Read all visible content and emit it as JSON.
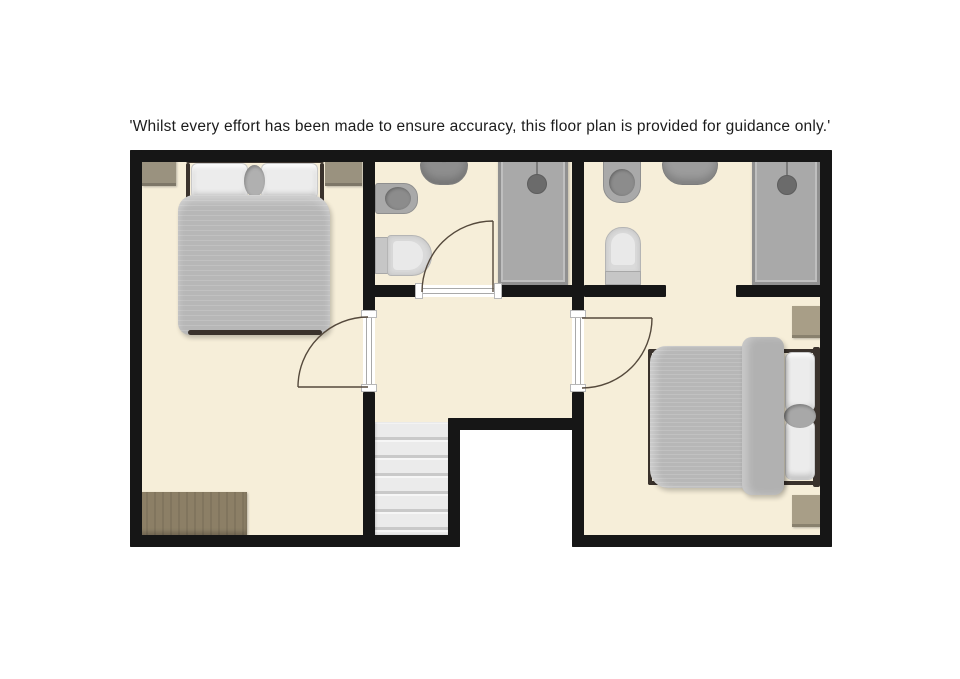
{
  "disclaimer": "'Whilst every effort has been made to ensure accuracy, this floor plan is provided for guidance only.'",
  "palette": {
    "canvas": "#ffffff",
    "wall": "#161616",
    "floor": "#f6eed9",
    "text": "#1c1c1c",
    "bed-duvet": "#b7b7b7",
    "pillow": "#ececec",
    "bed-frame": "#3a322c",
    "nightstand-1": "#9a927f",
    "nightstand-2": "#a89e87",
    "dresser": "#8c7f66",
    "shower": "#a9a9a9",
    "door-line": "#55493c"
  },
  "floorplan": {
    "level": "upper floor",
    "rooms": [
      {
        "name": "bedroom-1",
        "position": "left",
        "furniture": [
          "double-bed",
          "nightstand-left",
          "nightstand-right",
          "dresser"
        ]
      },
      {
        "name": "bathroom-1",
        "position": "top-middle",
        "furniture": [
          "sink",
          "bidet",
          "toilet",
          "shower-enclosure"
        ]
      },
      {
        "name": "bathroom-2",
        "position": "top-right",
        "furniture": [
          "bidet",
          "sink",
          "toilet",
          "shower-enclosure"
        ]
      },
      {
        "name": "landing",
        "position": "middle",
        "furniture": [
          "staircase"
        ]
      },
      {
        "name": "bedroom-2",
        "position": "right",
        "furniture": [
          "double-bed",
          "nightstand-top",
          "nightstand-bottom"
        ]
      }
    ],
    "doors": [
      {
        "between": "landing and bedroom-1",
        "type": "hinged, swings into bedroom-1"
      },
      {
        "between": "landing and bedroom-2",
        "type": "hinged, swings into bedroom-2"
      },
      {
        "between": "landing and bathroom-1",
        "type": "hinged, swings into bathroom-1"
      },
      {
        "between": "bedroom-2 and bathroom-2",
        "type": "open doorway"
      }
    ],
    "staircase": {
      "location": "bottom of landing",
      "treads_visible": 6
    }
  }
}
